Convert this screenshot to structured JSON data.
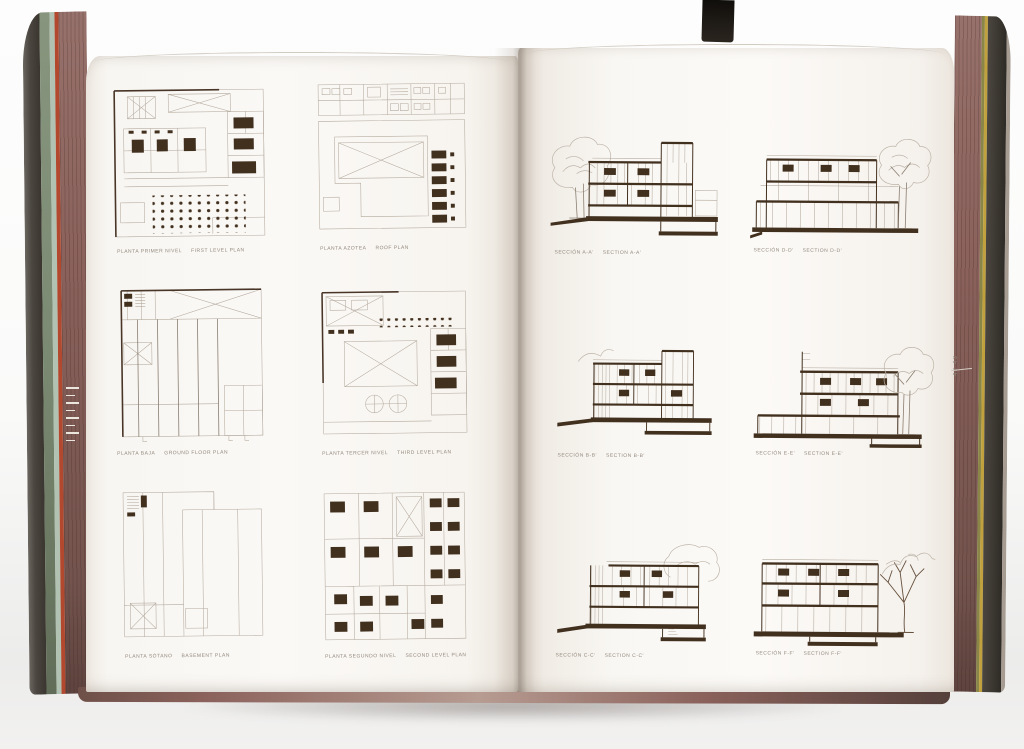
{
  "left_page": {
    "figures": [
      {
        "caption_es": "PLANTA PRIMER NIVEL",
        "caption_en": "FIRST LEVEL PLAN"
      },
      {
        "caption_es": "PLANTA AZOTEA",
        "caption_en": "ROOF PLAN"
      },
      {
        "caption_es": "PLANTA BAJA",
        "caption_en": "GROUND FLOOR PLAN"
      },
      {
        "caption_es": "PLANTA TERCER NIVEL",
        "caption_en": "THIRD LEVEL PLAN"
      },
      {
        "caption_es": "PLANTA SÓTANO",
        "caption_en": "BASEMENT PLAN"
      },
      {
        "caption_es": "PLANTA SEGUNDO NIVEL",
        "caption_en": "SECOND LEVEL PLAN"
      }
    ]
  },
  "right_page": {
    "figures": [
      {
        "caption_es": "SECCIÓN A-A'",
        "caption_en": "SECTION A-A'"
      },
      {
        "caption_es": "SECCIÓN D-D'",
        "caption_en": "SECTION D-D'"
      },
      {
        "caption_es": "SECCIÓN B-B'",
        "caption_en": "SECTION B-B'"
      },
      {
        "caption_es": "SECCIÓN E-E'",
        "caption_en": "SECTION E-E'"
      },
      {
        "caption_es": "SECCIÓN C-C'",
        "caption_en": "SECTION C-C'"
      },
      {
        "caption_es": "SECCIÓN F-F'",
        "caption_en": "SECTION F-F'"
      }
    ],
    "page_number": "42 43"
  },
  "palette": {
    "ink_dark": "#483527",
    "ink_mid": "#8a7e71",
    "ink_light": "#b3a99d",
    "slab": "#42301f",
    "tree_light": "#bdb4a8",
    "tree_dark": "#65503d",
    "caption": "#93897d",
    "edge_mauve": "#8a615b",
    "edge_green": "#7b8a73",
    "edge_pale": "#b2c2b2",
    "edge_red": "#b2492e",
    "edge_olive": "#8a8648",
    "edge_yellow": "#c1a13d",
    "cover_dark": "#3a362f"
  }
}
